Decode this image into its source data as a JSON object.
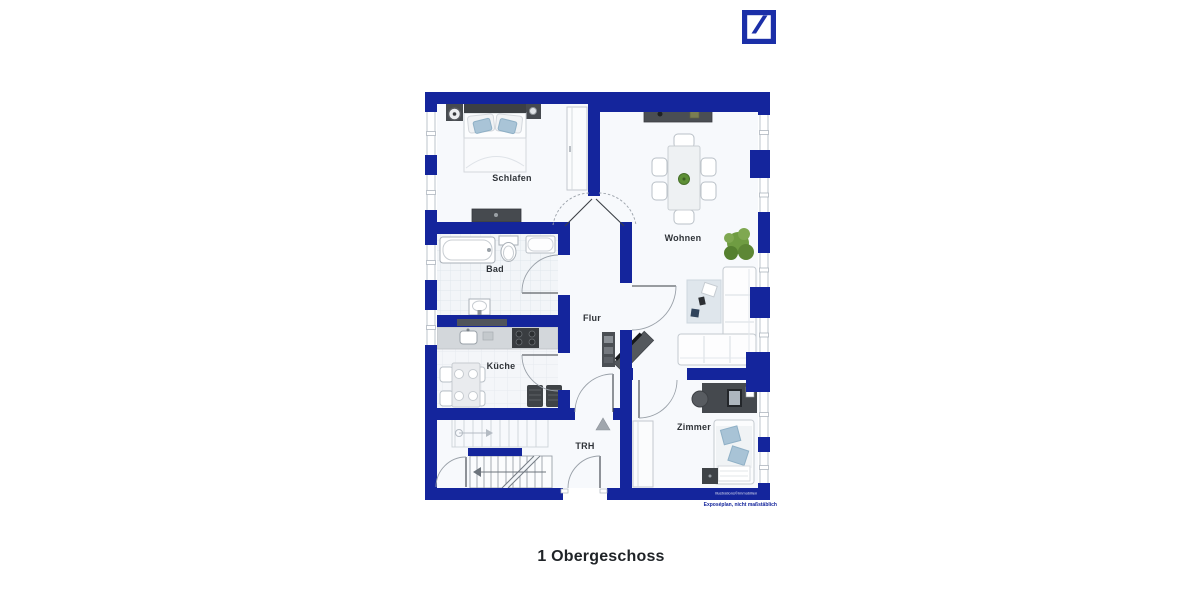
{
  "header": {
    "logo": {
      "name": "Deutsche Bank logo",
      "color": "#1B2FA8"
    }
  },
  "floorplan": {
    "wall_color": "#14259C",
    "floor_color": "#f7f9fc",
    "rooms": {
      "schlafen": "Schlafen",
      "wohnen": "Wohnen",
      "bad": "Bad",
      "flur": "Flur",
      "kueche": "Küche",
      "trh": "TRH",
      "zimmer": "Zimmer"
    },
    "furniture_colors": {
      "dark": "#464a4f",
      "counter": "#d3d7db",
      "cushion_blue": "#a9c4d7",
      "plant_green": "#6f9c42",
      "rug": "#dfe6ec"
    },
    "watermark": "Illustrations©Immobilien",
    "disclaimer": "Exposéplan, nicht maßstäblich"
  },
  "caption": "1 Obergeschoss"
}
